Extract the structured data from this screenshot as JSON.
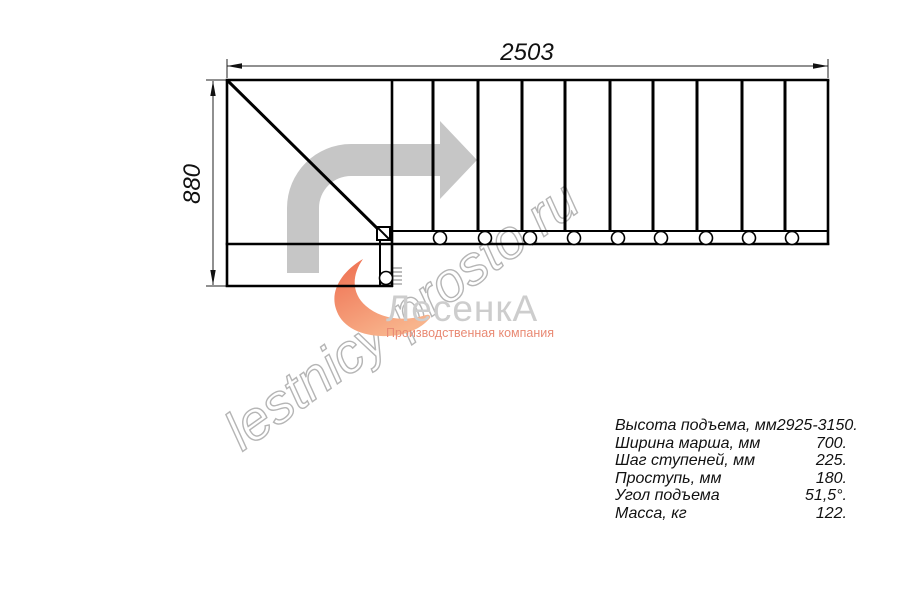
{
  "drawing": {
    "title": "L-shaped staircase top-view plan",
    "dim_width": "2503",
    "dim_height": "880"
  },
  "watermark": {
    "text": "lestnicy-prosto.ru"
  },
  "logo": {
    "name": "ЛесенкА",
    "tagline": "Производственная компания"
  },
  "specs": {
    "rows": [
      {
        "label": "Высота подъема, мм",
        "value": "2925-3150."
      },
      {
        "label": "Ширина марша, мм",
        "value": "700."
      },
      {
        "label": "Шаг ступеней, мм",
        "value": "225."
      },
      {
        "label": "Проступь, мм",
        "value": "180."
      },
      {
        "label": "Угол подъема",
        "value": "51,5°."
      },
      {
        "label": "Масса, кг",
        "value": "122."
      }
    ]
  },
  "icons": {
    "direction_arrow": "direction-arrow-icon",
    "logo_swoosh": "logo-swoosh-icon",
    "logo_stairs": "logo-stairs-icon"
  },
  "colors": {
    "line_black": "#000000",
    "dimension_gray": "#222222",
    "arrow_gray": "#c6c6c6",
    "watermark_gray": "#b5b5b5",
    "logo_text_gray": "#cdcdcd",
    "logo_orange": "#ee6d4f",
    "tagline_salmon": "#e98a74",
    "background": "#ffffff"
  }
}
